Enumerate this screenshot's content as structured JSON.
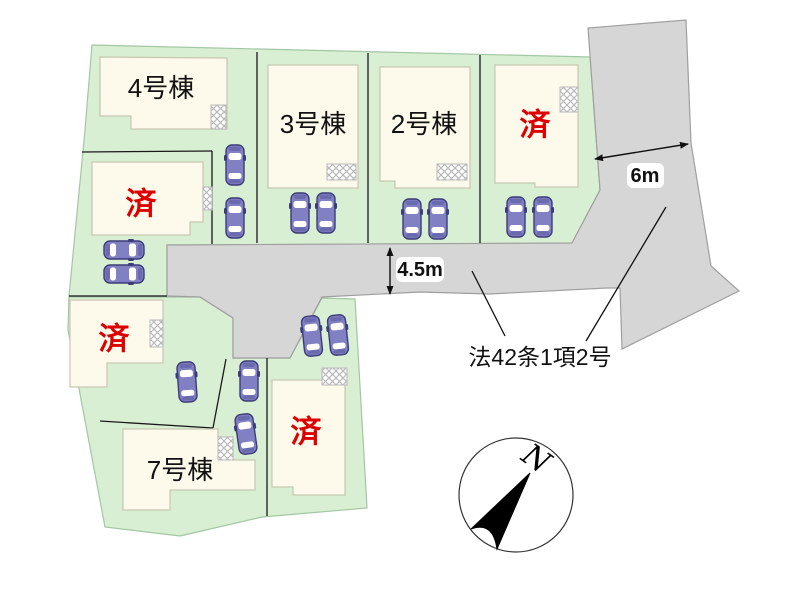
{
  "canvas": {
    "width": 800,
    "height": 600,
    "background": "#ffffff"
  },
  "palette": {
    "lot_fill": "#d9efd3",
    "lot_stroke": "#a3c6a3",
    "road_fill": "#d6d6d6",
    "road_stroke": "#9f9f9f",
    "building_fill": "#fdfaec",
    "building_stroke": "#c9c6b2",
    "boundary_line": "#1a1a1a",
    "car_body": "#8080c2",
    "car_trim": "#3c3c78",
    "car_band": "#6a6aae",
    "car_window": "#ffffff",
    "hatch_stroke": "#b9b9b9",
    "sold_text": "#dd0000",
    "label_text": "#111111"
  },
  "lot_blocks": [
    {
      "id": "north-block",
      "points": [
        [
          92,
          45
        ],
        [
          590,
          57
        ],
        [
          600,
          190
        ],
        [
          572,
          243
        ],
        [
          167,
          245
        ],
        [
          167,
          296
        ],
        [
          69,
          296
        ],
        [
          85,
          130
        ]
      ]
    },
    {
      "id": "south-block",
      "points": [
        [
          69,
          297
        ],
        [
          200,
          297
        ],
        [
          233,
          318
        ],
        [
          233,
          358
        ],
        [
          290,
          358
        ],
        [
          322,
          298
        ],
        [
          355,
          299
        ],
        [
          367,
          508
        ],
        [
          262,
          517
        ],
        [
          180,
          536
        ],
        [
          105,
          527
        ],
        [
          68,
          330
        ]
      ]
    }
  ],
  "boundary_lines": [
    [
      82,
      152,
      212,
      151
    ],
    [
      212,
      151,
      212,
      244
    ],
    [
      257,
      52,
      257,
      243
    ],
    [
      368,
      53,
      368,
      243
    ],
    [
      480,
      55,
      480,
      243
    ],
    [
      69,
      296,
      167,
      296
    ],
    [
      100,
      421,
      213,
      428
    ],
    [
      213,
      428,
      226,
      359
    ],
    [
      267,
      358,
      267,
      516
    ]
  ],
  "road": {
    "id": "road-surface",
    "points": [
      [
        167,
        245
      ],
      [
        572,
        243
      ],
      [
        600,
        190
      ],
      [
        588,
        28
      ],
      [
        686,
        20
      ],
      [
        691,
        143
      ],
      [
        711,
        266
      ],
      [
        739,
        291
      ],
      [
        622,
        349
      ],
      [
        620,
        288
      ],
      [
        607,
        288
      ],
      [
        490,
        294
      ],
      [
        420,
        292
      ],
      [
        322,
        297
      ],
      [
        290,
        358
      ],
      [
        233,
        358
      ],
      [
        233,
        318
      ],
      [
        200,
        297
      ],
      [
        167,
        296
      ]
    ]
  },
  "buildings": [
    {
      "id": "unit-4",
      "label": "4号棟",
      "sold": false,
      "points": [
        [
          100,
          57
        ],
        [
          227,
          58
        ],
        [
          227,
          129
        ],
        [
          131,
          129
        ],
        [
          131,
          116
        ],
        [
          100,
          116
        ]
      ],
      "label_xy": [
        161,
        88
      ],
      "hatch": [
        211,
        105,
        15,
        24
      ]
    },
    {
      "id": "unit-nw-sold",
      "label": "済",
      "sold": true,
      "points": [
        [
          92,
          162
        ],
        [
          203,
          162
        ],
        [
          203,
          222
        ],
        [
          190,
          222
        ],
        [
          190,
          235
        ],
        [
          92,
          235
        ]
      ],
      "label_xy": [
        141,
        204
      ],
      "hatch": [
        203,
        187,
        9,
        23
      ]
    },
    {
      "id": "unit-3",
      "label": "3号棟",
      "sold": false,
      "points": [
        [
          268,
          65
        ],
        [
          358,
          65
        ],
        [
          358,
          188
        ],
        [
          268,
          188
        ]
      ],
      "label_xy": [
        313,
        124
      ],
      "hatch": [
        327,
        164,
        29,
        16
      ]
    },
    {
      "id": "unit-2",
      "label": "2号棟",
      "sold": false,
      "points": [
        [
          380,
          67
        ],
        [
          470,
          67
        ],
        [
          470,
          188
        ],
        [
          395,
          188
        ],
        [
          395,
          181
        ],
        [
          380,
          181
        ]
      ],
      "label_xy": [
        424,
        124
      ],
      "hatch": [
        437,
        164,
        30,
        16
      ]
    },
    {
      "id": "unit-ne-sold",
      "label": "済",
      "sold": true,
      "points": [
        [
          495,
          65
        ],
        [
          578,
          65
        ],
        [
          578,
          187
        ],
        [
          535,
          187
        ],
        [
          535,
          183
        ],
        [
          495,
          183
        ]
      ],
      "label_xy": [
        535,
        125
      ],
      "hatch": [
        560,
        87,
        18,
        25
      ]
    },
    {
      "id": "unit-sw-sold",
      "label": "済",
      "sold": true,
      "points": [
        [
          70,
          300
        ],
        [
          163,
          300
        ],
        [
          163,
          363
        ],
        [
          107,
          363
        ],
        [
          107,
          387
        ],
        [
          70,
          387
        ]
      ],
      "label_xy": [
        114,
        339
      ],
      "hatch": [
        150,
        320,
        13,
        27
      ]
    },
    {
      "id": "unit-7",
      "label": "7号棟",
      "sold": false,
      "points": [
        [
          123,
          429
        ],
        [
          218,
          429
        ],
        [
          218,
          437
        ],
        [
          233,
          437
        ],
        [
          233,
          460
        ],
        [
          255,
          460
        ],
        [
          255,
          490
        ],
        [
          170,
          490
        ],
        [
          170,
          510
        ],
        [
          123,
          510
        ]
      ],
      "label_xy": [
        180,
        470
      ],
      "hatch": [
        218,
        437,
        15,
        23
      ]
    },
    {
      "id": "unit-sc-sold",
      "label": "済",
      "sold": true,
      "points": [
        [
          272,
          380
        ],
        [
          345,
          380
        ],
        [
          345,
          495
        ],
        [
          293,
          495
        ],
        [
          293,
          487
        ],
        [
          272,
          487
        ]
      ],
      "label_xy": [
        306,
        432
      ],
      "hatch": [
        322,
        368,
        25,
        17
      ]
    }
  ],
  "cars": [
    {
      "x": 124,
      "y": 250,
      "rot": 90
    },
    {
      "x": 124,
      "y": 274,
      "rot": 90
    },
    {
      "x": 235,
      "y": 165,
      "rot": 0
    },
    {
      "x": 235,
      "y": 218,
      "rot": 0
    },
    {
      "x": 300,
      "y": 213,
      "rot": 0
    },
    {
      "x": 326,
      "y": 213,
      "rot": 0
    },
    {
      "x": 412,
      "y": 219,
      "rot": 0
    },
    {
      "x": 438,
      "y": 219,
      "rot": 0
    },
    {
      "x": 516,
      "y": 217,
      "rot": 0
    },
    {
      "x": 543,
      "y": 217,
      "rot": 0
    },
    {
      "x": 187,
      "y": 382,
      "rot": -4
    },
    {
      "x": 249,
      "y": 381,
      "rot": 0
    },
    {
      "x": 246,
      "y": 434,
      "rot": -8
    },
    {
      "x": 312,
      "y": 336,
      "rot": -6
    },
    {
      "x": 338,
      "y": 335,
      "rot": -6
    }
  ],
  "dimensions": [
    {
      "id": "road-width-4-5m",
      "label": "4.5m",
      "arrow": [
        390,
        248,
        390,
        294
      ],
      "box": [
        396,
        257,
        48,
        25
      ],
      "label_xy": [
        420,
        270
      ]
    },
    {
      "id": "road-width-6m",
      "label": "6m",
      "arrow": [
        595,
        159,
        688,
        144
      ],
      "box": [
        627,
        163,
        37,
        25
      ],
      "label_xy": [
        645,
        176
      ]
    }
  ],
  "legal_note": {
    "label": "法42条1項2号",
    "label_xy": [
      540,
      357
    ],
    "leaders": [
      [
        472,
        271,
        505,
        336
      ],
      [
        666,
        207,
        586,
        341
      ]
    ]
  },
  "compass": {
    "label": "N",
    "cx": 516,
    "cy": 495,
    "r": 57,
    "needle_path": "M530,473 L471,529 Q493,521 497,549 Z",
    "label_xy": [
      536,
      459
    ],
    "label_rotation": 35
  }
}
